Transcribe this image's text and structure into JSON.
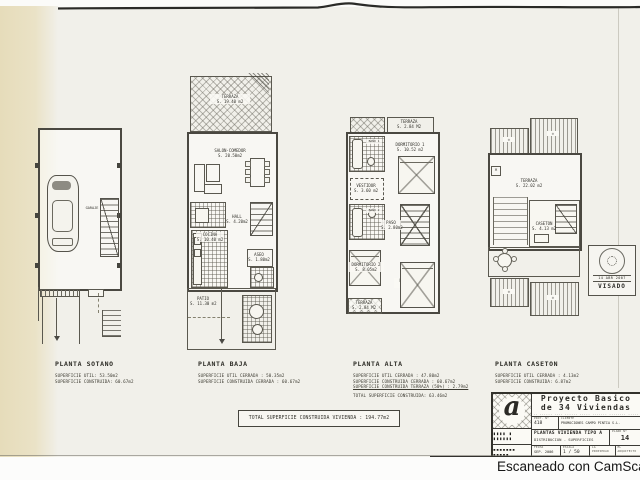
{
  "page": {
    "scanner_note": "Escaneado con CamScanner"
  },
  "plans": {
    "sotano": {
      "title": "PLANTA SOTANO",
      "surfaces": [
        "SUPERFICIE UTIL: 53.50m2",
        "SUPERFICIE CONSTRUIDA: 60.67m2"
      ],
      "rooms": {
        "garaje": "GARAJE"
      }
    },
    "baja": {
      "title": "PLANTA BAJA",
      "surfaces": [
        "SUPERFICIE UTIL CERRADA : 50.35m2",
        "SUPERFICIE CONSTRUIDA CERRADA : 60.67m2"
      ],
      "rooms": {
        "terraza": "TERRAZA\nS. 19.40 m2",
        "salon": "SALON-COMEDOR\nS. 20.50m2",
        "cocina": "COCINA\nS. 10.40 m2",
        "hall": "HALL\nS. 4.20m2",
        "aseo": "ASEO\nS. 1.80m2",
        "patio": "PATIO\nS. 11.30 m2"
      }
    },
    "alta": {
      "title": "PLANTA ALTA",
      "surfaces": [
        "SUPERFICIE UTIL CERRADA : 47.80m2",
        "SUPERFICIE CONSTRUIDA CERRADA : 60.67m2",
        "SUPERFICIE CONSTRUIDA TERRAZA (50%) : 2.79m2",
        "TOTAL SUPERFICIE CONSTRUIDA: 63.46m2"
      ],
      "rooms": {
        "terraza_top": "TERRAZA\nS. 2.84 M2",
        "dorm1": "DORMITORIO 1\nS. 10.52 m2",
        "bano1": "BAÑO 1",
        "vestidor": "VESTIDOR\nS. 3.60 m2",
        "bano2": "BAÑO 2",
        "paso": "PASO\nS. 2.80m2",
        "dorm2": "DORMITORIO 2\nS. 8.05m2",
        "dorm3": "DORMITORIO 3\nS. 10.95 m2",
        "terraza_bottom": "TERRAZA\nS. 2.84 M2"
      }
    },
    "caseton": {
      "title": "PLANTA CASETON",
      "surfaces": [
        "SUPERFICIE UTIL CERRADA : 4.13m2",
        "SUPERFICIE CONSTRUIDA: 6.87m2"
      ],
      "rooms": {
        "terraza": "TERRAZA\nS. 22.02 m2",
        "caseton": "CASETON\nS. 4.13 m2"
      }
    }
  },
  "total_line": "TOTAL SUPERFICIE CONSTRUIDA VIVIENDA :  194.77m2",
  "stamp": {
    "date": "14 ABR 2007",
    "label": "VISADO"
  },
  "title_block": {
    "project_title_1": "Proyecto Basico",
    "project_title_2": "de 34 Viviendas",
    "project_subtitle": "·· ······ ···· ······ ····· ······· ········ ·····",
    "proy_no_label": "PROY. Nº",
    "proy_no_value": "418",
    "cliente_label": "CLIENTE",
    "cliente_value": "PROMOCIONES CAMPO PINTIA S.L.",
    "sheet_title_1": "PLANTAS VIVIENDA  TIPO A",
    "sheet_title_2": "DISTRIBUCION - SUPERFICIES",
    "plano_label": "PLANO Nº",
    "plano_value": "14",
    "fecha_label": "FECHA",
    "fecha_value": "SEP. 2006",
    "escala_label": "ESCALA",
    "escala_value": "1 / 50",
    "propiedad_label": "LA PROPIEDAD",
    "arquitecto_label": "EL ARQUITECTO",
    "logo_glyph": "a",
    "architect_row_1": "▮▮▮▮ ▮ ▮▮▮▮▮▮",
    "architect_row_2": "▪▪▪▪▪▪▪ ▪▪▪▪▪"
  }
}
